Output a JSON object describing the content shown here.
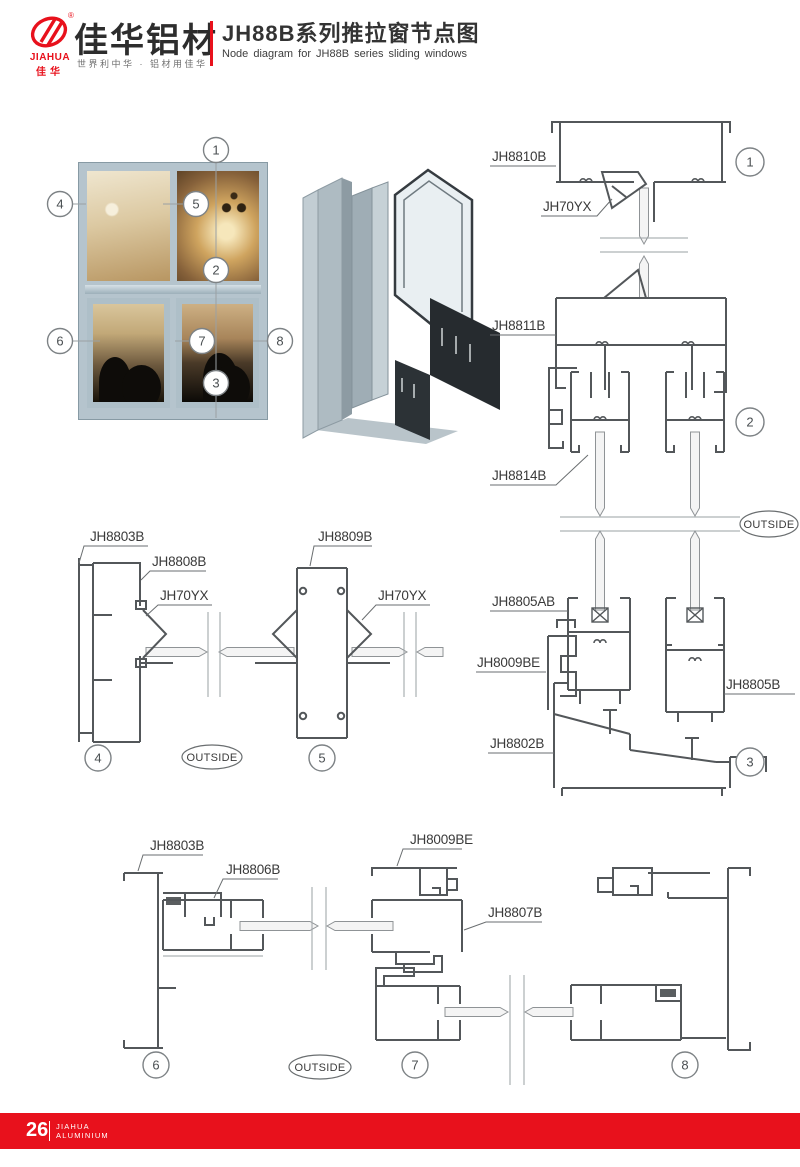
{
  "header": {
    "logo": {
      "brand_en": "JIAHUA",
      "brand_cn": "佳华",
      "registered_mark": "®"
    },
    "brand_title": "佳华铝材",
    "brand_slogan": "世界利中华 · 铝材用佳华",
    "doc_title_cn": "JH88B系列推拉窗节点图",
    "doc_title_en": "Node diagram for JH88B series sliding windows"
  },
  "overview": {
    "callouts": [
      "1",
      "2",
      "3",
      "4",
      "5",
      "6",
      "7",
      "8"
    ]
  },
  "sections": {
    "outside": "OUTSIDE",
    "right": {
      "callout_top": "1",
      "callout_mid": "2",
      "callout_bottom": "3",
      "jh8810b": "JH8810B",
      "jh70yx": "JH70YX",
      "jh8811b": "JH8811B",
      "jh8814b": "JH8814B",
      "jh8805ab": "JH8805AB",
      "jh8009be": "JH8009BE",
      "jh8805b": "JH8805B",
      "jh8802b": "JH8802B"
    },
    "mid": {
      "callout_left": "4",
      "callout_right": "5",
      "jh8803b": "JH8803B",
      "jh8808b": "JH8808B",
      "jh70yx_a": "JH70YX",
      "jh8809b": "JH8809B",
      "jh70yx_b": "JH70YX"
    },
    "bottom": {
      "callout_left": "6",
      "callout_mid": "7",
      "callout_right": "8",
      "jh8803b": "JH8803B",
      "jh8806b": "JH8806B",
      "jh8009be": "JH8009BE",
      "jh8807b": "JH8807B"
    }
  },
  "footer": {
    "page_number": "26",
    "brand_line1": "JIAHUA",
    "brand_line2": "ALUMINIUM"
  },
  "colors": {
    "brand_red": "#e8111c",
    "drawing_line": "#53575a",
    "frame_blue": "#b5c4cd"
  }
}
